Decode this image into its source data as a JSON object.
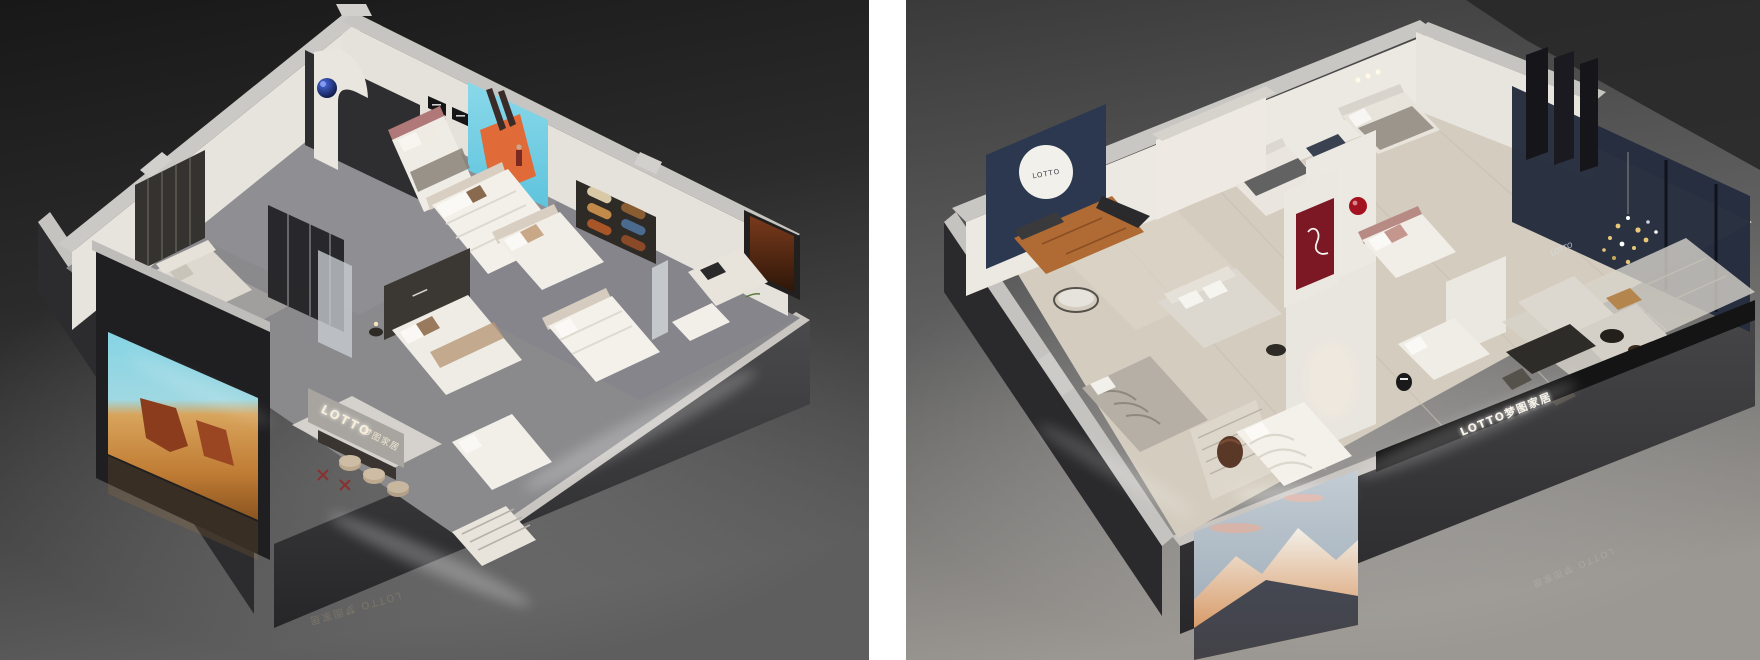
{
  "page": {
    "background": "#ffffff",
    "divider_color": "#ffffff"
  },
  "brand": {
    "name": "LOTTO",
    "cn_name": "梦图家居",
    "full_name": "LOTTO 梦图家居"
  },
  "left_panel": {
    "theme": "dark bedding showroom isometric cutaway render",
    "wall_sign": {
      "latin": "LOTTO",
      "cn": "梦图家居"
    },
    "floor_watermark": "LOTTO 梦图家居",
    "artworks": {
      "led_screen": "desert canyon photo wall",
      "mural": "blue sky with orange architecture and figure",
      "fabric_display": "rolled fabric sample wall",
      "art_panel": "rust abstract painting"
    },
    "palette": {
      "background_top": "#1a1a1a",
      "background_bottom": "#5c5c5c",
      "carpet": "#8a8a8d",
      "wall_white": "#e8e4de",
      "wall_cap": "#c9c7c3",
      "sign_glow": "#f7eed9",
      "watermark": "#9b8e74",
      "screen_sky": "#86d4e4",
      "screen_sand": "#c07c34",
      "screen_rock": "#8a3c1c",
      "mural_sky": "#7ad2e6",
      "mural_orange": "#e06a38",
      "sphere_blue": "#1c3fae",
      "art_rust": "#7a3a1c",
      "fabric_colors": [
        "#d9c9a7",
        "#c28a4a",
        "#a85628",
        "#8a5c32",
        "#4a6a8e",
        "#8a4a28"
      ]
    }
  },
  "right_panel": {
    "theme": "light bedding showroom isometric cutaway render",
    "disc_logo": "LOTTO",
    "beam_sign": "LOTTO梦图家居",
    "wall_script": "LOTTO",
    "floor_watermark": "LOTTO 梦图家居",
    "artworks": {
      "photo": "snow mountain at sunset",
      "red_niche": "burgundy niche with sculptural lamp"
    },
    "palette": {
      "background_top": "#303030",
      "background_bottom": "#9b9893",
      "floor_wood": "#d4cdbf",
      "wall_white": "#ece8e2",
      "wall_cap": "#c9c7c3",
      "navy_wall": "#2c3850",
      "navy_room": "#242c3e",
      "leather": "#b06a34",
      "red_panel": "#7c1824",
      "red_sphere": "#a31220",
      "mountain_sky": "#b7c2cb",
      "mountain_snow": "#ece8e0",
      "mountain_glow": "#d08040",
      "mountain_shadow": "#333b49",
      "sign_glow": "#f5f0e4",
      "watermark": "#b8b5b0"
    }
  }
}
